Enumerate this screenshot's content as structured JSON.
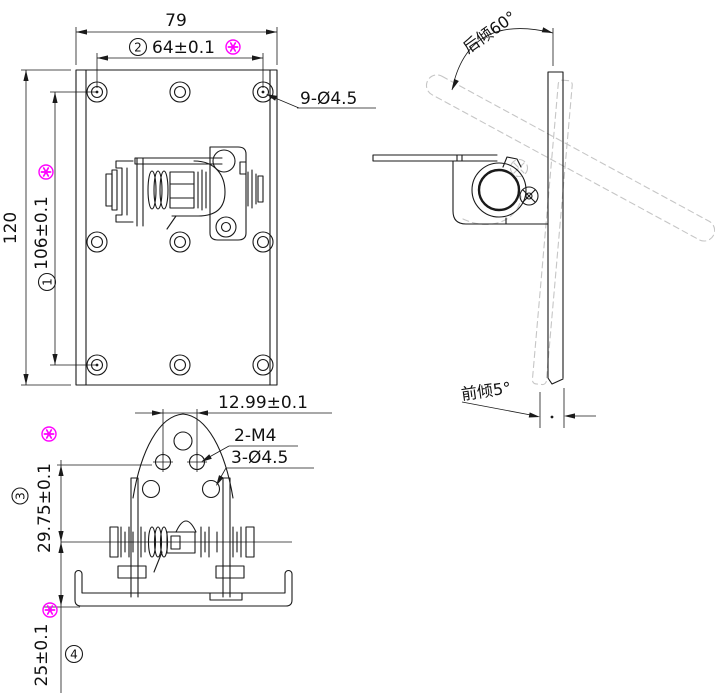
{
  "drawing": {
    "front": {
      "width": "79",
      "bolt_span_h": "64±0.1",
      "bolt_span_h_ref": "2",
      "height": "120",
      "bolt_span_v": "106±0.1",
      "bolt_span_v_ref": "1",
      "holes_callout": "9-Ø4.5"
    },
    "side": {
      "back_tilt_label": "后倾60°",
      "front_tilt_label": "前倾5°"
    },
    "bottom": {
      "slot_pitch": "12.99±0.1",
      "thread_callout": "2-M4",
      "holes_callout": "3-Ø4.5",
      "axis_height": "29.75±0.1",
      "axis_height_ref": "3",
      "base_offset": "25±0.1",
      "base_offset_ref": "4"
    },
    "icons": {
      "critical_flag": "circled-asterisk"
    },
    "colors": {
      "line": "#1a1a1a",
      "ghost": "#c6c6c6",
      "flag": "#ff00ff",
      "background": "#ffffff"
    }
  }
}
